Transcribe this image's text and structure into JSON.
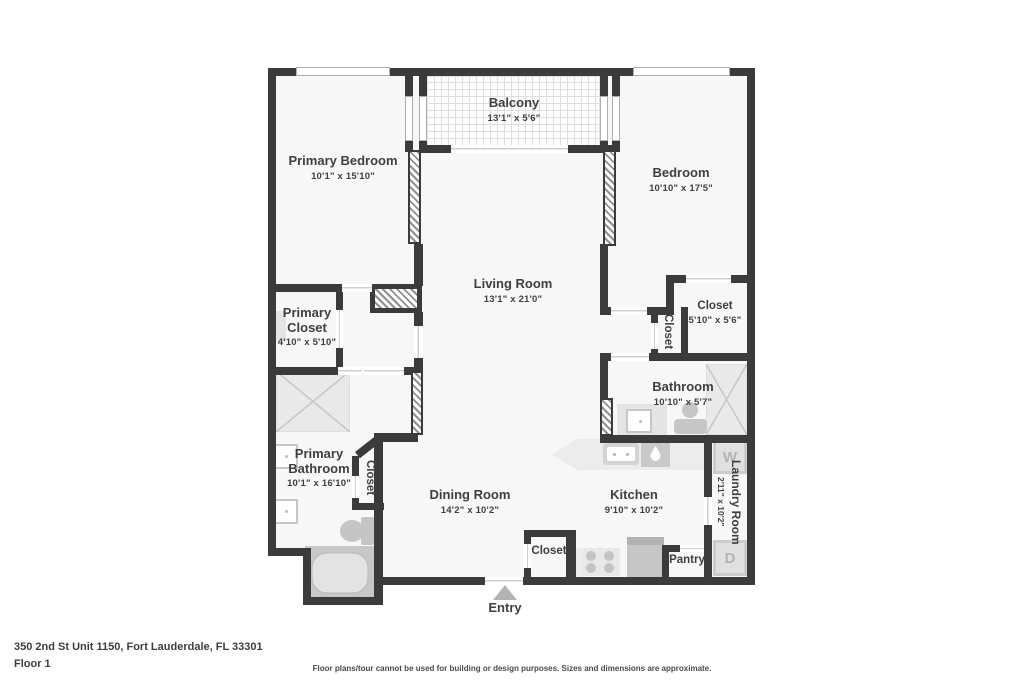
{
  "rooms": [
    {
      "name": "Primary Bedroom",
      "dims": "10'1\" x 15'10\""
    },
    {
      "name": "Balcony",
      "dims": "13'1\" x 5'6\""
    },
    {
      "name": "Bedroom",
      "dims": "10'10\" x 17'5\""
    },
    {
      "name": "Living Room",
      "dims": "13'1\" x 21'0\""
    },
    {
      "name": "Primary Closet",
      "dims": "4'10\" x 5'10\""
    },
    {
      "name": "Closet",
      "dims": "5'10\" x 5'6\""
    },
    {
      "name": "Bathroom",
      "dims": "10'10\" x 5'7\""
    },
    {
      "name": "Primary Bathroom",
      "dims": "10'1\" x 16'10\""
    },
    {
      "name": "Dining Room",
      "dims": "14'2\" x 10'2\""
    },
    {
      "name": "Kitchen",
      "dims": "9'10\" x 10'2\""
    },
    {
      "name": "Laundry Room",
      "dims": "2'11\" x 10'2\""
    }
  ],
  "labels": {
    "hall_closet": "Closet",
    "vestibule_closet": "Closet",
    "entry_closet": "Closet",
    "pantry": "Pantry",
    "entry": "Entry"
  },
  "appliances": {
    "washer": "W",
    "dryer": "D"
  },
  "footer": {
    "address": "350 2nd St Unit 1150, Fort Lauderdale, FL 33301",
    "floor": "Floor 1",
    "disclaimer": "Floor plans/tour cannot be used for building or design purposes. Sizes and dimensions are approximate."
  },
  "colors": {
    "wall": "#3b3b3b",
    "floor": "#f7f7f7",
    "fixture": "#d8d8d8",
    "text": "#3f3f3f"
  }
}
